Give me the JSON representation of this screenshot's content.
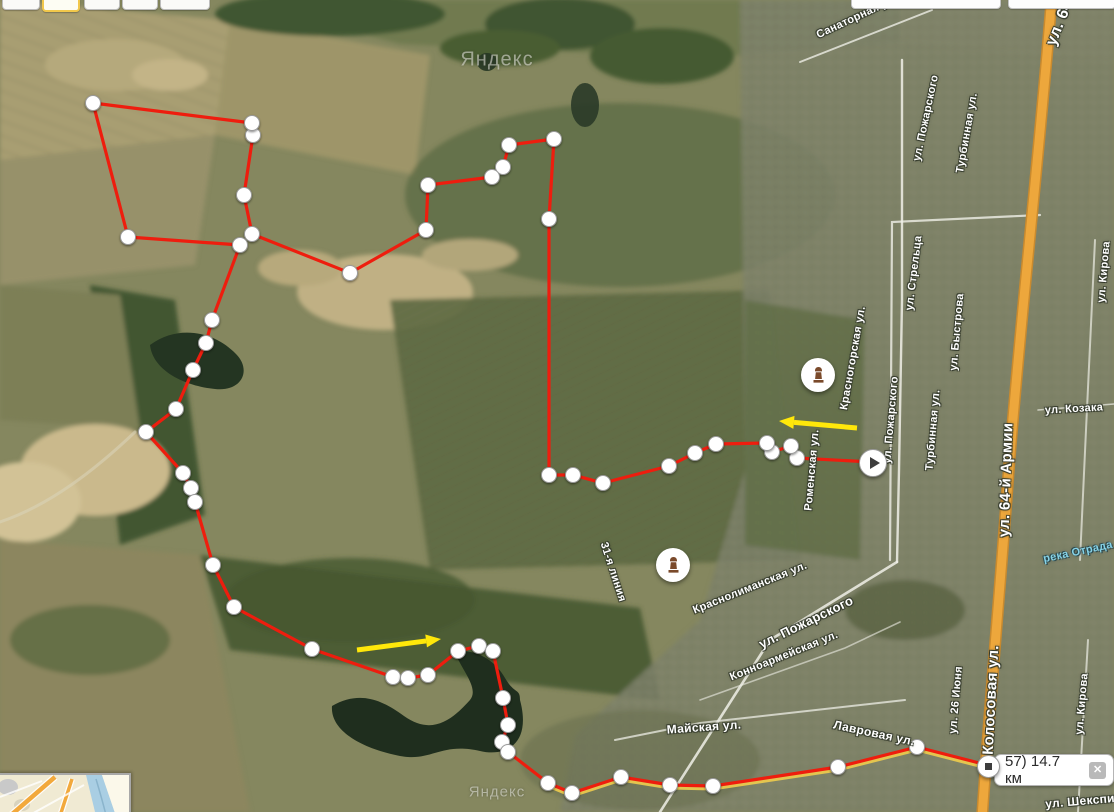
{
  "app": {
    "watermarks": [
      {
        "text": "Яндекс",
        "x": 497,
        "y": 60,
        "size": 20
      },
      {
        "text": "Яндекс",
        "x": 497,
        "y": 792,
        "size": 15
      }
    ]
  },
  "colors": {
    "route": "#ee1d0e",
    "arrow": "#ffe70a",
    "major_road": "#eda73c",
    "minor_road": "#e9c84e",
    "monument_icon": "#7a4a2b"
  },
  "measure_badge": {
    "distance_text": "57) 14.7 км",
    "close_label": "✕"
  },
  "markers": {
    "start": {
      "x": 872,
      "y": 462,
      "icon": "play-triangle-icon"
    },
    "end": {
      "x": 987,
      "y": 765,
      "icon": "stop-square-icon"
    }
  },
  "placemarks": [
    {
      "x": 818,
      "y": 375,
      "icon": "monument-icon"
    },
    {
      "x": 673,
      "y": 565,
      "icon": "monument-icon"
    }
  ],
  "arrows": [
    {
      "x1": 857,
      "y1": 428,
      "x2": 779,
      "y2": 421
    },
    {
      "x1": 357,
      "y1": 650,
      "x2": 441,
      "y2": 639
    }
  ],
  "route": {
    "points": [
      [
        872,
        462
      ],
      [
        797,
        458
      ],
      [
        791,
        446
      ],
      [
        772,
        452
      ],
      [
        767,
        443
      ],
      [
        716,
        444
      ],
      [
        695,
        453
      ],
      [
        669,
        466
      ],
      [
        603,
        483
      ],
      [
        573,
        475
      ],
      [
        549,
        475
      ],
      [
        549,
        219
      ],
      [
        554,
        139
      ],
      [
        509,
        145
      ],
      [
        503,
        167
      ],
      [
        492,
        177
      ],
      [
        428,
        185
      ],
      [
        426,
        230
      ],
      [
        350,
        273
      ],
      [
        252,
        234
      ],
      [
        244,
        195
      ],
      [
        253,
        135
      ],
      [
        252,
        123
      ],
      [
        93,
        103
      ],
      [
        128,
        237
      ],
      [
        240,
        245
      ],
      [
        212,
        320
      ],
      [
        206,
        343
      ],
      [
        193,
        370
      ],
      [
        176,
        409
      ],
      [
        146,
        432
      ],
      [
        183,
        473
      ],
      [
        191,
        488
      ],
      [
        195,
        502
      ],
      [
        213,
        565
      ],
      [
        234,
        607
      ],
      [
        312,
        649
      ],
      [
        393,
        677
      ],
      [
        408,
        678
      ],
      [
        428,
        675
      ],
      [
        458,
        651
      ],
      [
        479,
        646
      ],
      [
        493,
        651
      ],
      [
        503,
        698
      ],
      [
        508,
        725
      ],
      [
        502,
        742
      ],
      [
        508,
        752
      ],
      [
        548,
        783
      ],
      [
        572,
        793
      ],
      [
        621,
        777
      ],
      [
        670,
        785
      ],
      [
        713,
        786
      ],
      [
        838,
        767
      ],
      [
        917,
        747
      ],
      [
        987,
        765
      ]
    ]
  },
  "map": {
    "labels": [
      {
        "text": "Санаторная ул.",
        "x": 857,
        "y": 17,
        "rot": -25,
        "size": 11
      },
      {
        "text": "ул. 64-й",
        "x": 1063,
        "y": 16,
        "rot": -68,
        "size": 16
      },
      {
        "text": "ул. Пожарского",
        "x": 926,
        "y": 118,
        "rot": -78,
        "size": 11
      },
      {
        "text": "Турбинная ул.",
        "x": 967,
        "y": 133,
        "rot": -80,
        "size": 11
      },
      {
        "text": "ул. Стрельца",
        "x": 914,
        "y": 273,
        "rot": -83,
        "size": 11
      },
      {
        "text": "ул. Быстрова",
        "x": 957,
        "y": 332,
        "rot": -85,
        "size": 11
      },
      {
        "text": "ул. Кирова",
        "x": 1104,
        "y": 272,
        "rot": -85,
        "size": 11
      },
      {
        "text": "ул. Козака",
        "x": 1074,
        "y": 409,
        "rot": -3,
        "size": 11
      },
      {
        "text": "Красногорская ул.",
        "x": 853,
        "y": 358,
        "rot": -80,
        "size": 11
      },
      {
        "text": "ул. Пожарского",
        "x": 891,
        "y": 420,
        "rot": -85,
        "size": 11
      },
      {
        "text": "Турбинная ул.",
        "x": 933,
        "y": 430,
        "rot": -85,
        "size": 11
      },
      {
        "text": "Роменская ул.",
        "x": 812,
        "y": 470,
        "rot": -85,
        "size": 11
      },
      {
        "text": "ул. 64-й Армии",
        "x": 1006,
        "y": 480,
        "rot": -88,
        "size": 15
      },
      {
        "text": "река Отрада",
        "x": 1078,
        "y": 552,
        "rot": -12,
        "size": 11,
        "kind": "water"
      },
      {
        "text": "31-я линия",
        "x": 613,
        "y": 572,
        "rot": 72,
        "size": 11
      },
      {
        "text": "Краснолиманская ул.",
        "x": 750,
        "y": 588,
        "rot": -22,
        "size": 11
      },
      {
        "text": "ул. Пожарского",
        "x": 806,
        "y": 622,
        "rot": -26,
        "size": 13
      },
      {
        "text": "Конноармейская ул.",
        "x": 784,
        "y": 656,
        "rot": -22,
        "size": 11
      },
      {
        "text": "Майская ул.",
        "x": 704,
        "y": 727,
        "rot": -4,
        "size": 12
      },
      {
        "text": "Лавровая ул.",
        "x": 874,
        "y": 733,
        "rot": 12,
        "size": 12
      },
      {
        "text": "ул. 26 Июня",
        "x": 956,
        "y": 700,
        "rot": -85,
        "size": 11
      },
      {
        "text": "Колосовая ул.",
        "x": 991,
        "y": 700,
        "rot": -87,
        "size": 15
      },
      {
        "text": "ул. Кирова",
        "x": 1082,
        "y": 704,
        "rot": -85,
        "size": 11
      },
      {
        "text": "ул. Шекспи",
        "x": 1080,
        "y": 801,
        "rot": -5,
        "size": 12
      }
    ]
  }
}
